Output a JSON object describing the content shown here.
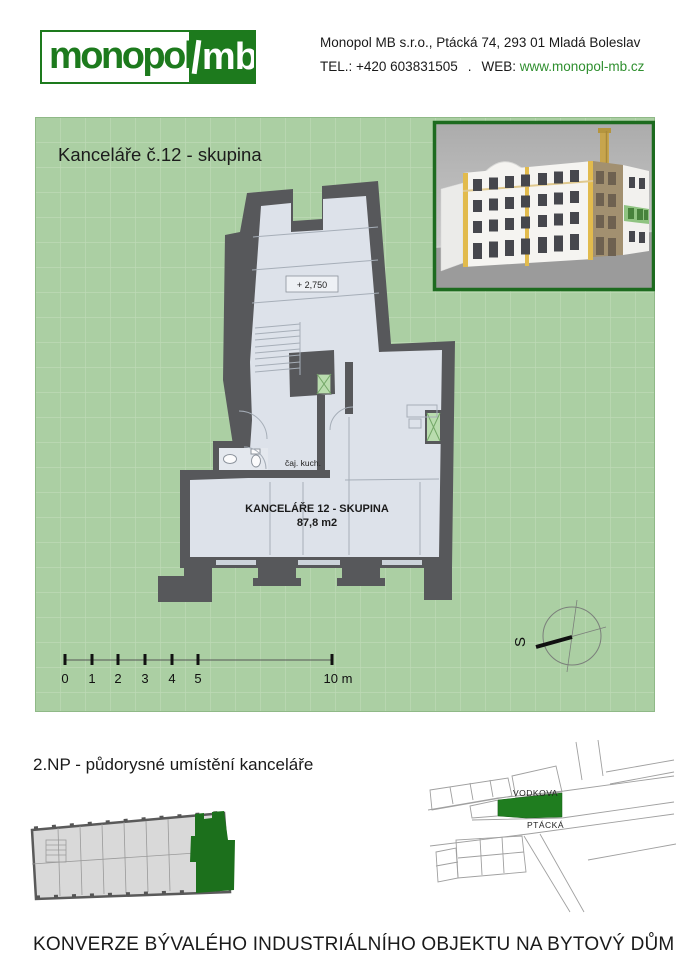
{
  "header": {
    "logo": {
      "part1": "monopol",
      "part2": "mb"
    },
    "address_line": "Monopol MB s.r.o., Ptácká 74, 293 01 Mladá Boleslav",
    "tel": "TEL.: +420 603831505",
    "separator": ".",
    "web_label": "WEB:",
    "web_url": "www.monopol-mb.cz"
  },
  "plan_panel": {
    "title": "Kanceláře č.12 - skupina",
    "labels": {
      "level": "+ 2,750",
      "room_name": "KANCELÁŘE 12 - SKUPINA",
      "room_area": "87,8 m2",
      "kitchen": "čaj. kuch."
    },
    "scale_bar": {
      "ticks": [
        "0",
        "1",
        "2",
        "3",
        "4",
        "5"
      ],
      "end_label": "10 m"
    },
    "compass": {
      "north_label": "S"
    }
  },
  "location_section": {
    "title": "2.NP - půdorysné umístění kanceláře",
    "map": {
      "street_top": "VODKOVA",
      "street_bottom": "PTÁCKÁ"
    }
  },
  "footer": {
    "title": "KONVERZE BÝVALÉHO INDUSTRIÁLNÍHO OBJEKTU NA BYTOVÝ DŮM"
  },
  "colors": {
    "brand_green": "#1d7a1d",
    "link_green": "#2f8f2f",
    "panel_green": "#abcfa3",
    "grid_green": "#bedab6",
    "wall_gray": "#57585b",
    "room_fill": "#dde2ea",
    "shaft_green": "#b9dcae",
    "highlight_green": "#1c701c"
  }
}
